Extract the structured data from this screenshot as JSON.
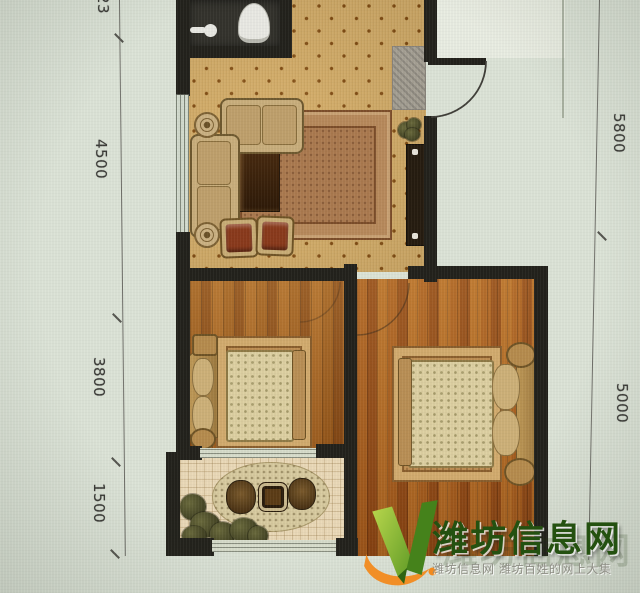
{
  "dimensions": {
    "left": [
      {
        "label": "23"
      },
      {
        "label": "4500"
      },
      {
        "label": "3800"
      },
      {
        "label": "1500"
      }
    ],
    "right": [
      {
        "label": "5800"
      },
      {
        "label": "5000"
      }
    ]
  },
  "watermark": {
    "brand": "潍坊信息网",
    "tagline": "潍坊信息网 潍坊百姓的网上大集",
    "logo_icon": "green-v-check-icon",
    "brand_color": "#245110",
    "logo_green_light": "#a8cf43",
    "logo_green_dark": "#4e8a1f",
    "logo_orange": "#f28a1d"
  },
  "plan": {
    "furniture_icons": [
      "toilet-icon",
      "sink-icon",
      "entry-door-swing-icon",
      "doormat-icon",
      "tv-cabinet-icon",
      "sofa-icon",
      "loveseat-icon",
      "armchair-icon",
      "coffee-table-icon",
      "area-rug-icon",
      "side-table-icon",
      "bed-icon",
      "pillow-icon",
      "nightstand-icon",
      "window-icon",
      "plant-icon",
      "patio-table-icon",
      "patio-chair-icon",
      "oval-rug-icon"
    ],
    "wall_color": "#23221c",
    "living_floor_color": "#d7b26d",
    "bedroom_floor_color": "#a2611f",
    "balcony_floor_color": "#ead9b8"
  }
}
